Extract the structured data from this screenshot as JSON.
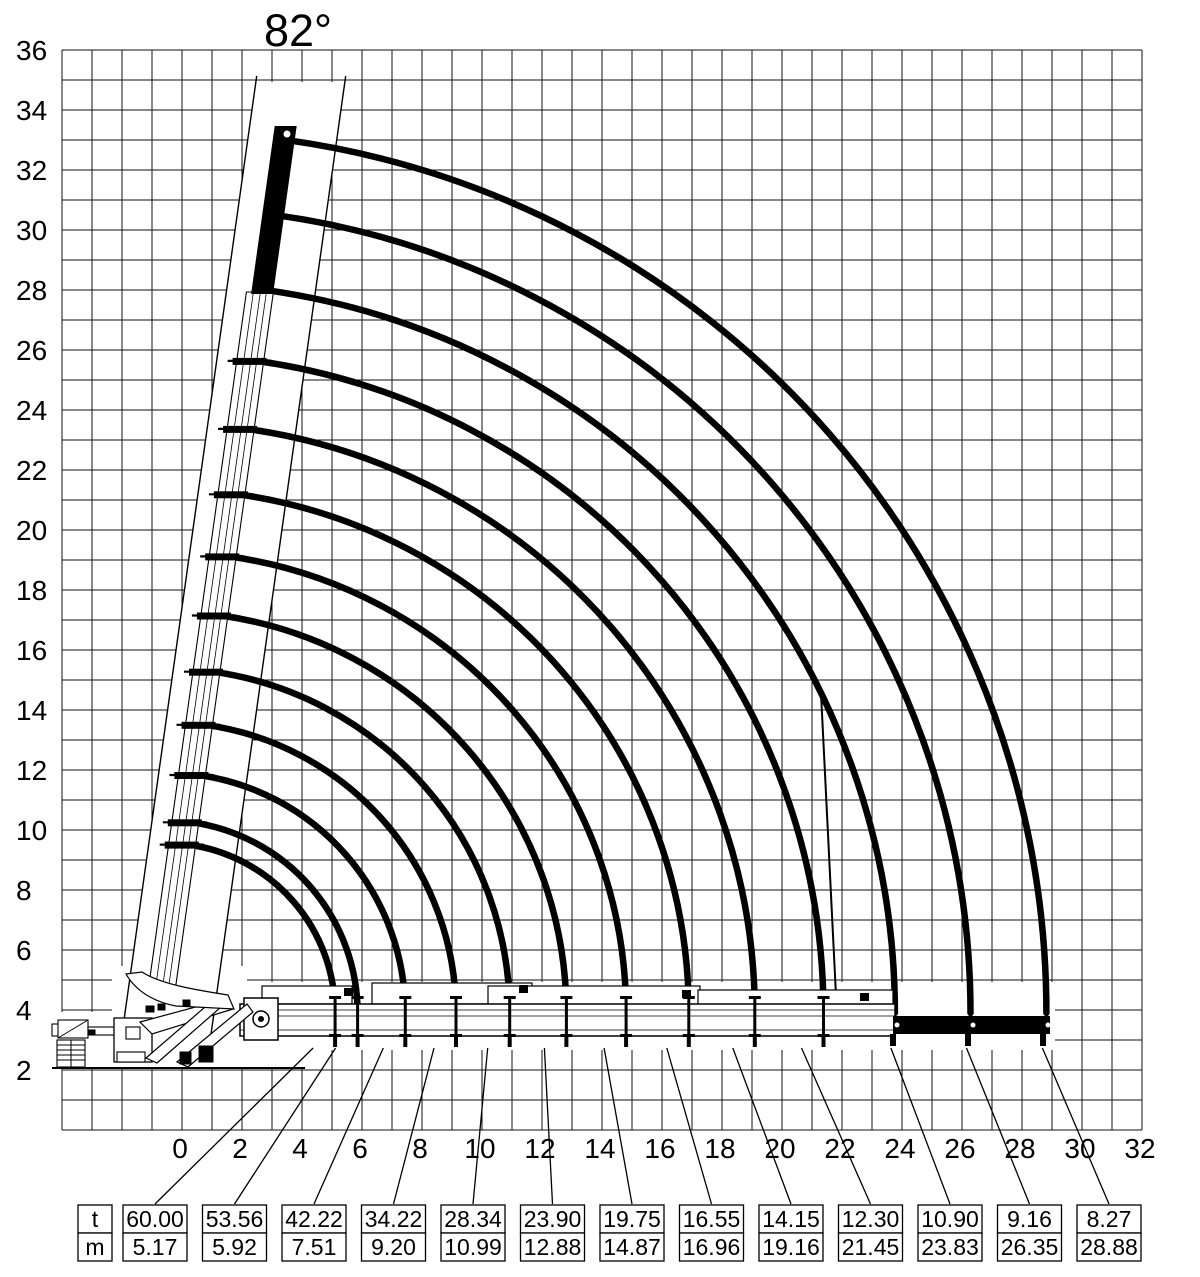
{
  "chart_data": {
    "type": "line",
    "title": "",
    "boom_angle_label": "82°",
    "grid": true,
    "x_axis": {
      "ticks": [
        0,
        2,
        4,
        6,
        8,
        10,
        12,
        14,
        16,
        18,
        20,
        22,
        24,
        26,
        28,
        30,
        32
      ],
      "range": [
        -4,
        32
      ]
    },
    "y_axis": {
      "ticks": [
        2,
        4,
        6,
        8,
        10,
        12,
        14,
        16,
        18,
        20,
        22,
        24,
        26,
        28,
        30,
        32,
        34,
        36
      ],
      "range": [
        0,
        36
      ]
    },
    "curves": {
      "description": "boom-tip arcs from 82 deg to horizontal",
      "start_angle_deg": 82,
      "end_angle_deg": 0,
      "radii_m": [
        5.17,
        5.92,
        7.51,
        9.2,
        10.99,
        12.88,
        14.87,
        16.96,
        19.16,
        21.45,
        23.83,
        26.35,
        28.88
      ]
    },
    "table": {
      "row_labels": [
        "t",
        "m"
      ],
      "load_t": [
        "60.00",
        "53.56",
        "42.22",
        "34.22",
        "28.34",
        "23.90",
        "19.75",
        "16.55",
        "14.15",
        "12.30",
        "10.90",
        "9.16",
        "8.27"
      ],
      "radius_m": [
        "5.17",
        "5.92",
        "7.51",
        "9.20",
        "10.99",
        "12.88",
        "14.87",
        "16.96",
        "19.16",
        "21.45",
        "23.83",
        "26.35",
        "28.88"
      ]
    },
    "colors": {
      "ink": "#000000",
      "background": "#ffffff"
    }
  }
}
